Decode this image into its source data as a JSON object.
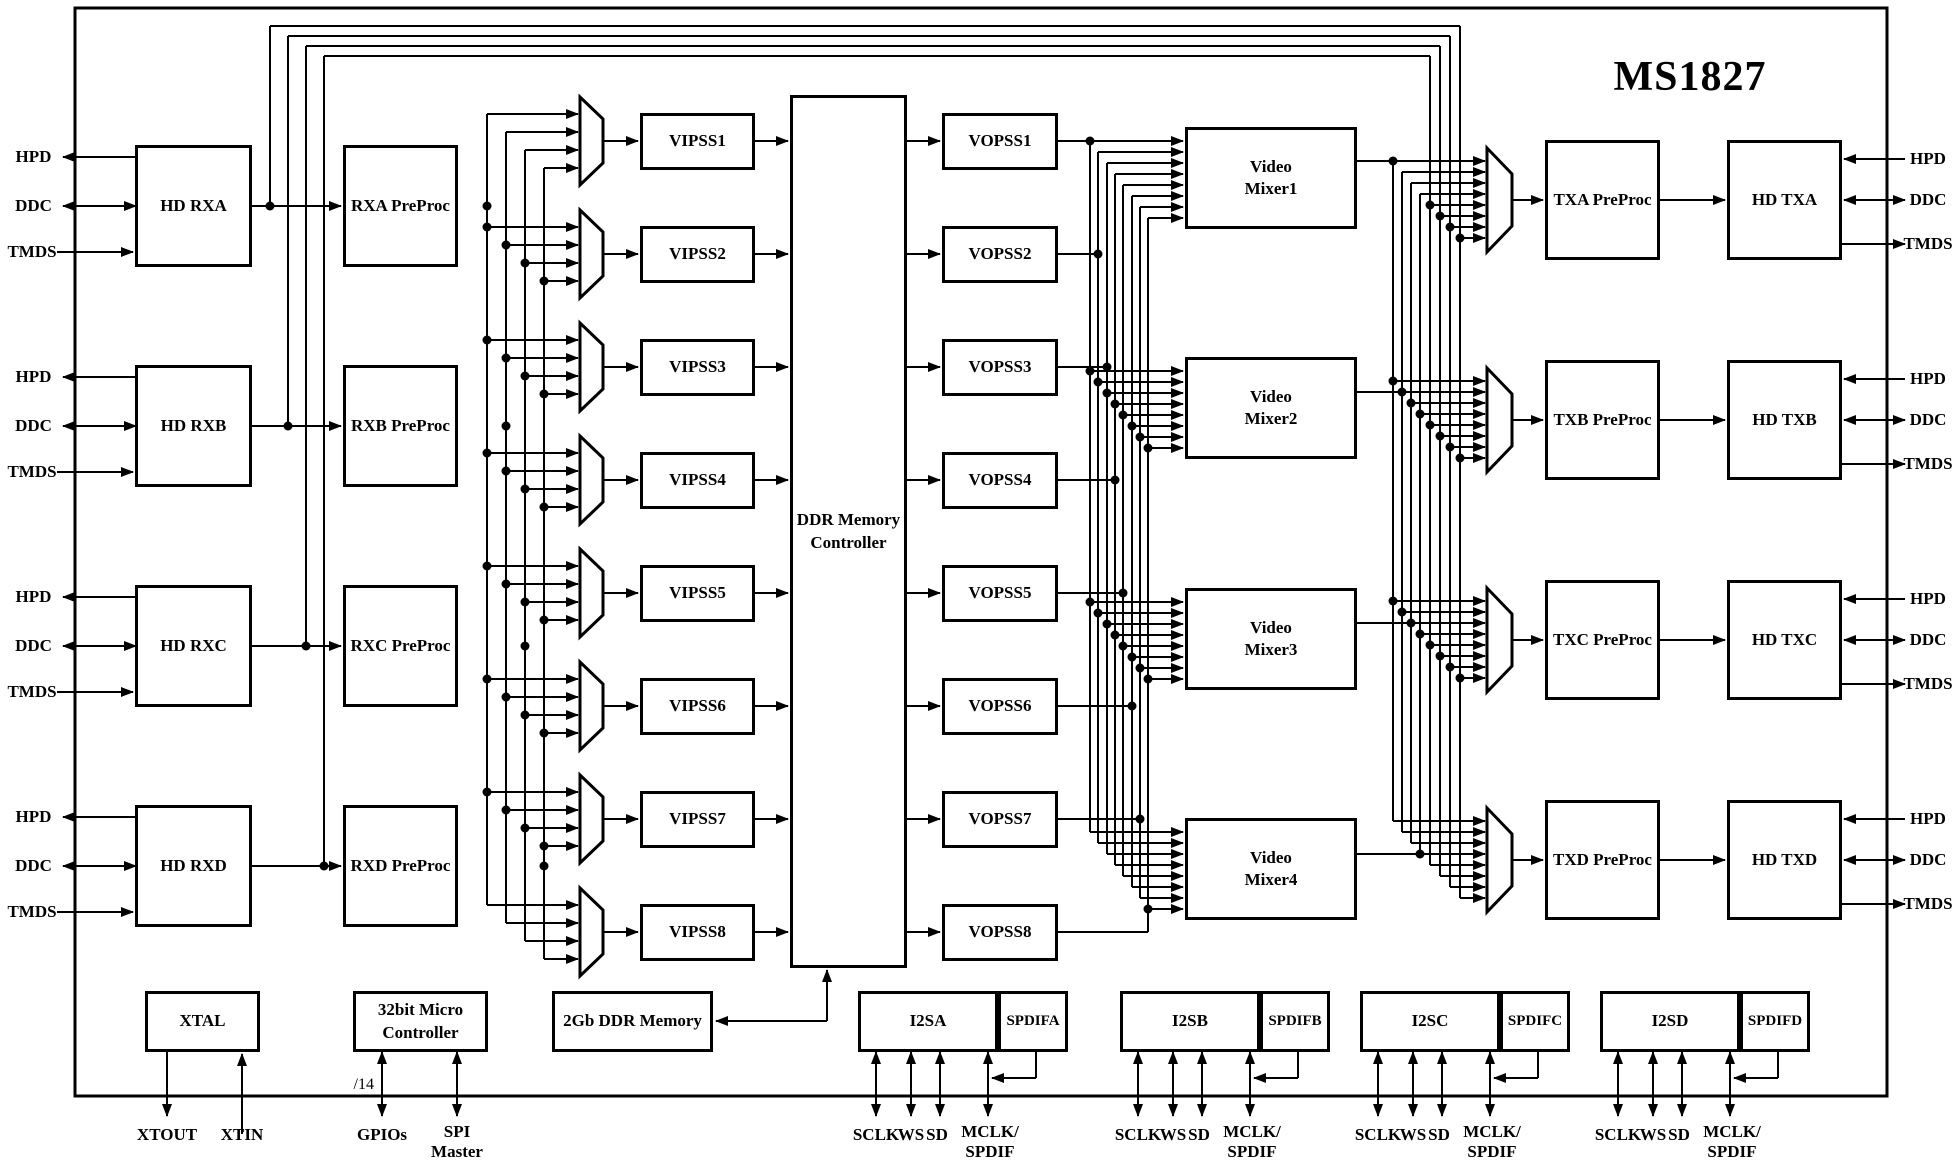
{
  "title": "MS1827",
  "rx_rows": [
    {
      "receiver": "HD RXA",
      "preproc": "RXA PreProc",
      "hpd": "HPD",
      "ddc": "DDC",
      "tmds": "TMDS"
    },
    {
      "receiver": "HD RXB",
      "preproc": "RXB PreProc",
      "hpd": "HPD",
      "ddc": "DDC",
      "tmds": "TMDS"
    },
    {
      "receiver": "HD RXC",
      "preproc": "RXC PreProc",
      "hpd": "HPD",
      "ddc": "DDC",
      "tmds": "TMDS"
    },
    {
      "receiver": "HD RXD",
      "preproc": "RXD PreProc",
      "hpd": "HPD",
      "ddc": "DDC",
      "tmds": "TMDS"
    }
  ],
  "vipss": [
    "VIPSS1",
    "VIPSS2",
    "VIPSS3",
    "VIPSS4",
    "VIPSS5",
    "VIPSS6",
    "VIPSS7",
    "VIPSS8"
  ],
  "ddr_controller": "DDR Memory\nController",
  "vopss": [
    "VOPSS1",
    "VOPSS2",
    "VOPSS3",
    "VOPSS4",
    "VOPSS5",
    "VOPSS6",
    "VOPSS7",
    "VOPSS8"
  ],
  "mixers": [
    "Video\nMixer1",
    "Video\nMixer2",
    "Video\nMixer3",
    "Video\nMixer4"
  ],
  "tx_rows": [
    {
      "preproc": "TXA PreProc",
      "transmitter": "HD TXA",
      "hpd": "HPD",
      "ddc": "DDC",
      "tmds": "TMDS"
    },
    {
      "preproc": "TXB PreProc",
      "transmitter": "HD TXB",
      "hpd": "HPD",
      "ddc": "DDC",
      "tmds": "TMDS"
    },
    {
      "preproc": "TXC PreProc",
      "transmitter": "HD TXC",
      "hpd": "HPD",
      "ddc": "DDC",
      "tmds": "TMDS"
    },
    {
      "preproc": "TXD PreProc",
      "transmitter": "HD TXD",
      "hpd": "HPD",
      "ddc": "DDC",
      "tmds": "TMDS"
    }
  ],
  "bottom": {
    "xtal": "XTAL",
    "xtout": "XTOUT",
    "xtin": "XTIN",
    "mcu": "32bit Micro\nController",
    "gpios": "GPIOs",
    "bus_width": "/14",
    "spi_master": "SPI\nMaster",
    "ddr_memory": "2Gb DDR Memory",
    "audio_groups": [
      {
        "i2s": "I2SA",
        "spdif": "SPDIFA",
        "sclk": "SCLK",
        "ws": "WS",
        "sd": "SD",
        "mclk": "MCLK/\nSPDIF"
      },
      {
        "i2s": "I2SB",
        "spdif": "SPDIFB",
        "sclk": "SCLK",
        "ws": "WS",
        "sd": "SD",
        "mclk": "MCLK/\nSPDIF"
      },
      {
        "i2s": "I2SC",
        "spdif": "SPDIFC",
        "sclk": "SCLK",
        "ws": "WS",
        "sd": "SD",
        "mclk": "MCLK/\nSPDIF"
      },
      {
        "i2s": "I2SD",
        "spdif": "SPDIFD",
        "sclk": "SCLK",
        "ws": "WS",
        "sd": "SD",
        "mclk": "MCLK/\nSPDIF"
      }
    ]
  }
}
